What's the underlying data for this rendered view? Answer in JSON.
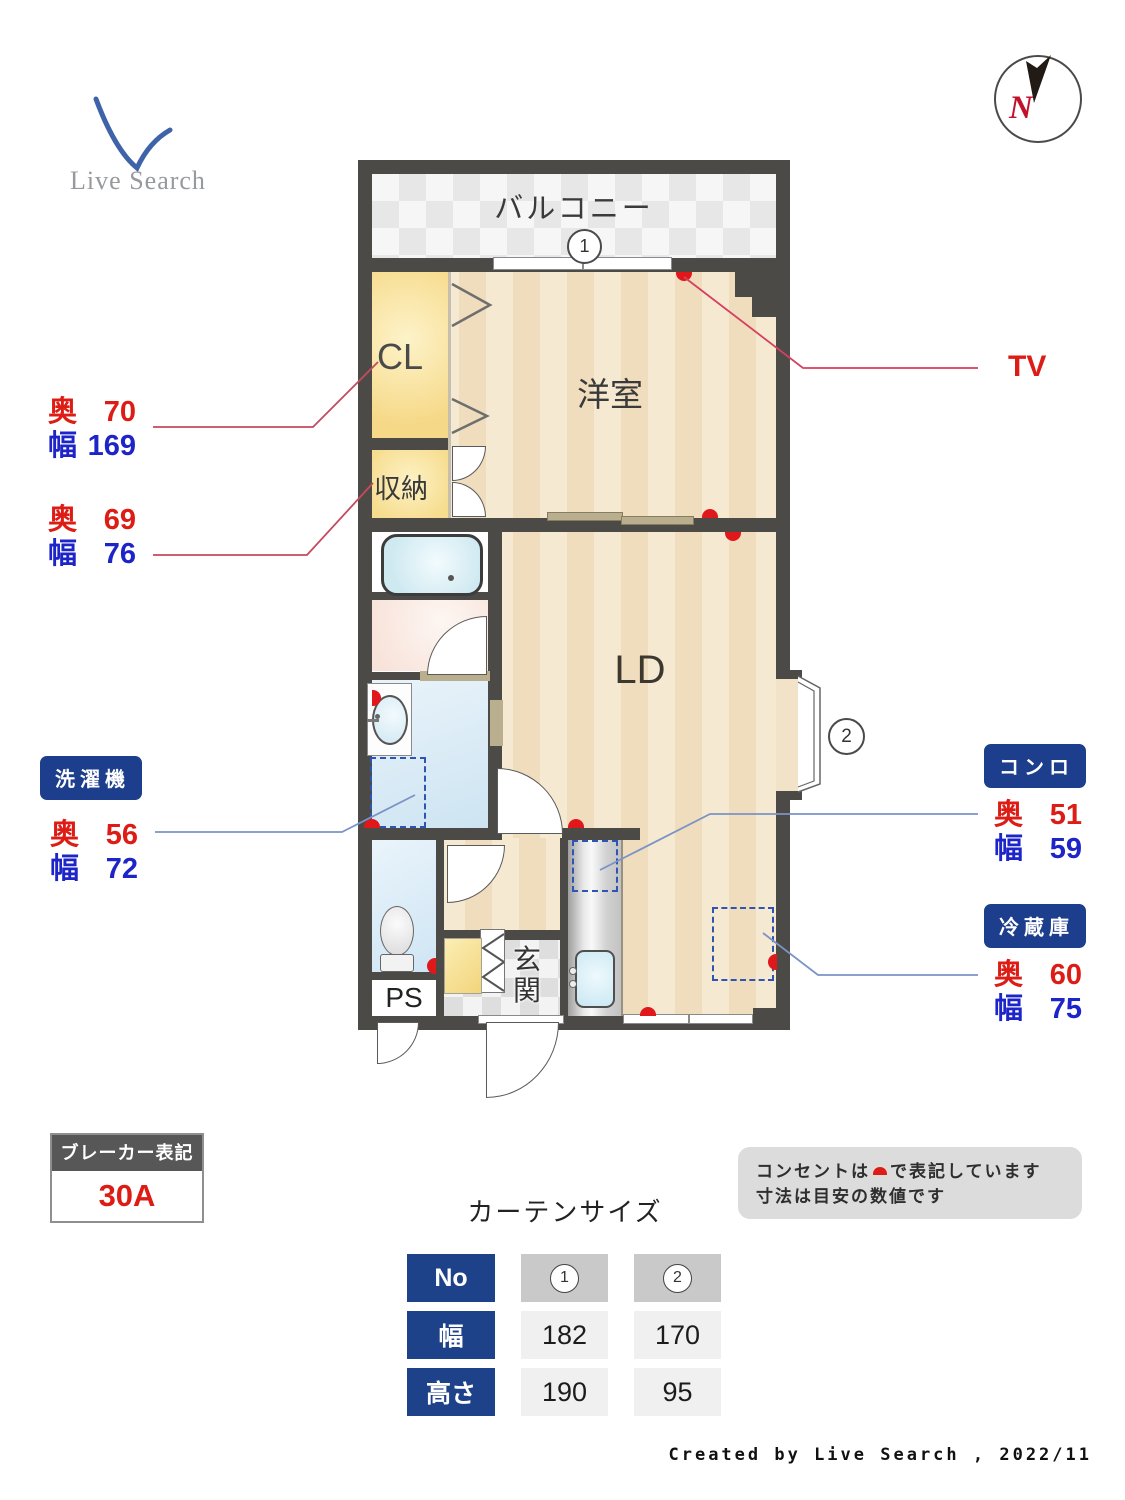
{
  "brand": {
    "logo_text": "Live Search",
    "compass_n": "N"
  },
  "rooms": {
    "balcony": "バルコニー",
    "western": "洋室",
    "closet": "CL",
    "storage": "収納",
    "living": "LD",
    "entrance_char1": "玄",
    "entrance_char2": "関",
    "pipe_space": "PS"
  },
  "markers": {
    "win1": "1",
    "win2": "2"
  },
  "dim_labels": {
    "depth": "奥",
    "width": "幅"
  },
  "annotations": {
    "closet": {
      "depth": "70",
      "width": "169"
    },
    "storage": {
      "depth": "69",
      "width": "76"
    },
    "washer": {
      "title": "洗濯機",
      "depth": "56",
      "width": "72"
    },
    "stove": {
      "title": "コンロ",
      "depth": "51",
      "width": "59"
    },
    "fridge": {
      "title": "冷蔵庫",
      "depth": "60",
      "width": "75"
    },
    "tv": "TV"
  },
  "breaker": {
    "title": "ブレーカー表記",
    "value": "30A"
  },
  "note": {
    "line1_before": "コンセントは",
    "line1_after": "で表記しています",
    "line2": "寸法は目安の数値です"
  },
  "curtain": {
    "title": "カーテンサイズ",
    "row_headers": [
      "No",
      "幅",
      "高さ"
    ],
    "no_row": [
      "1",
      "2"
    ],
    "width_row": [
      "182",
      "170"
    ],
    "height_row": [
      "190",
      "95"
    ]
  },
  "footer": "Created by Live Search , 2022/11",
  "colors": {
    "wall": "#4c4a47",
    "accent_red": "#dd1d15",
    "accent_blue": "#1d24c8",
    "badge_blue": "#1c3e8c"
  }
}
